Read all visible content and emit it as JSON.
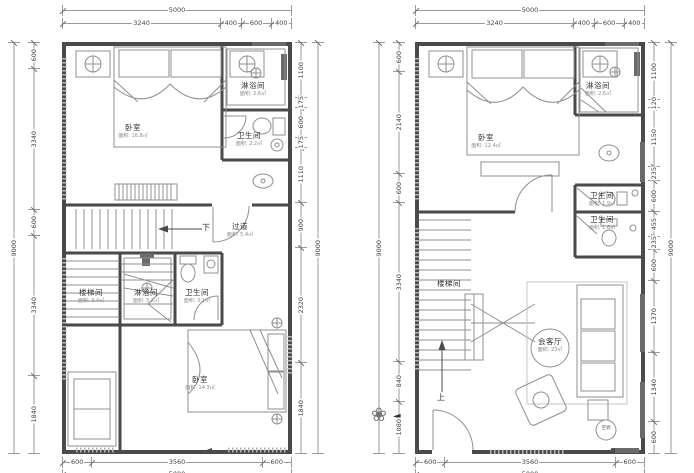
{
  "drawing": {
    "type": "floor-plan",
    "colors": {
      "wall": "#4a4a4a",
      "furniture": "#8f8f8f",
      "dimension": "#9a9a9a",
      "text": "#333333"
    }
  },
  "left_plan": {
    "dims": {
      "top_overall": "5000",
      "top_segments": [
        "3240",
        "400",
        "600",
        "400"
      ],
      "left_overall": "9000",
      "left_segments": [
        "600",
        "3340",
        "600",
        "3340",
        "1840"
      ],
      "right_overall": "9000",
      "right_segments": [
        "1100",
        "175",
        "600",
        "175",
        "1110",
        "900",
        "2320",
        "1840"
      ],
      "bottom_segments": [
        "600",
        "3560",
        "600"
      ],
      "bottom_overall": "5000"
    },
    "rooms": {
      "bedroom_top": {
        "name": "卧室",
        "area": "面积: 16.8㎡"
      },
      "shower_top": {
        "name": "淋浴间",
        "area": "面积: 2.6㎡"
      },
      "wc_top": {
        "name": "卫生间",
        "area": "面积: 2.2㎡"
      },
      "corridor": {
        "name": "过道",
        "area": "面积: 5.4㎡"
      },
      "down_label": "下",
      "stair_room": {
        "name": "楼梯间",
        "area": "面积: 3.4㎡"
      },
      "shower_mid": {
        "name": "淋浴间",
        "area": "面积: 3.2㎡"
      },
      "wc_mid": {
        "name": "卫生间",
        "area": "面积: 3.1㎡"
      },
      "bedroom_bottom": {
        "name": "卧室",
        "area": "面积: 14.3㎡"
      }
    }
  },
  "right_plan": {
    "dims": {
      "top_overall": "5000",
      "top_segments": [
        "3240",
        "400",
        "600",
        "400"
      ],
      "left_overall": "9000",
      "left_segments": [
        "600",
        "2140",
        "600",
        "3340",
        "840",
        "1080"
      ],
      "right_overall": "9000",
      "right_segments": [
        "1100",
        "120",
        "1150",
        "235",
        "600",
        "455",
        "235",
        "600",
        "1370",
        "1340",
        "600"
      ],
      "bottom_segments": [
        "600",
        "3560",
        "600"
      ],
      "bottom_overall": "5000"
    },
    "rooms": {
      "bedroom": {
        "name": "卧室",
        "area": "面积: 12.4㎡"
      },
      "shower": {
        "name": "淋浴间",
        "area": "面积: 2.6㎡"
      },
      "wc_upper": {
        "name": "卫生间",
        "area": "面积: 1.9㎡"
      },
      "wc_lower": {
        "name": "卫生间",
        "area": "面积: 1.6㎡"
      },
      "stair_room": {
        "name": "楼梯间"
      },
      "living": {
        "name": "会客厅",
        "area": "面积: 23㎡"
      },
      "up_label": "上",
      "ac_label": "空调"
    }
  }
}
